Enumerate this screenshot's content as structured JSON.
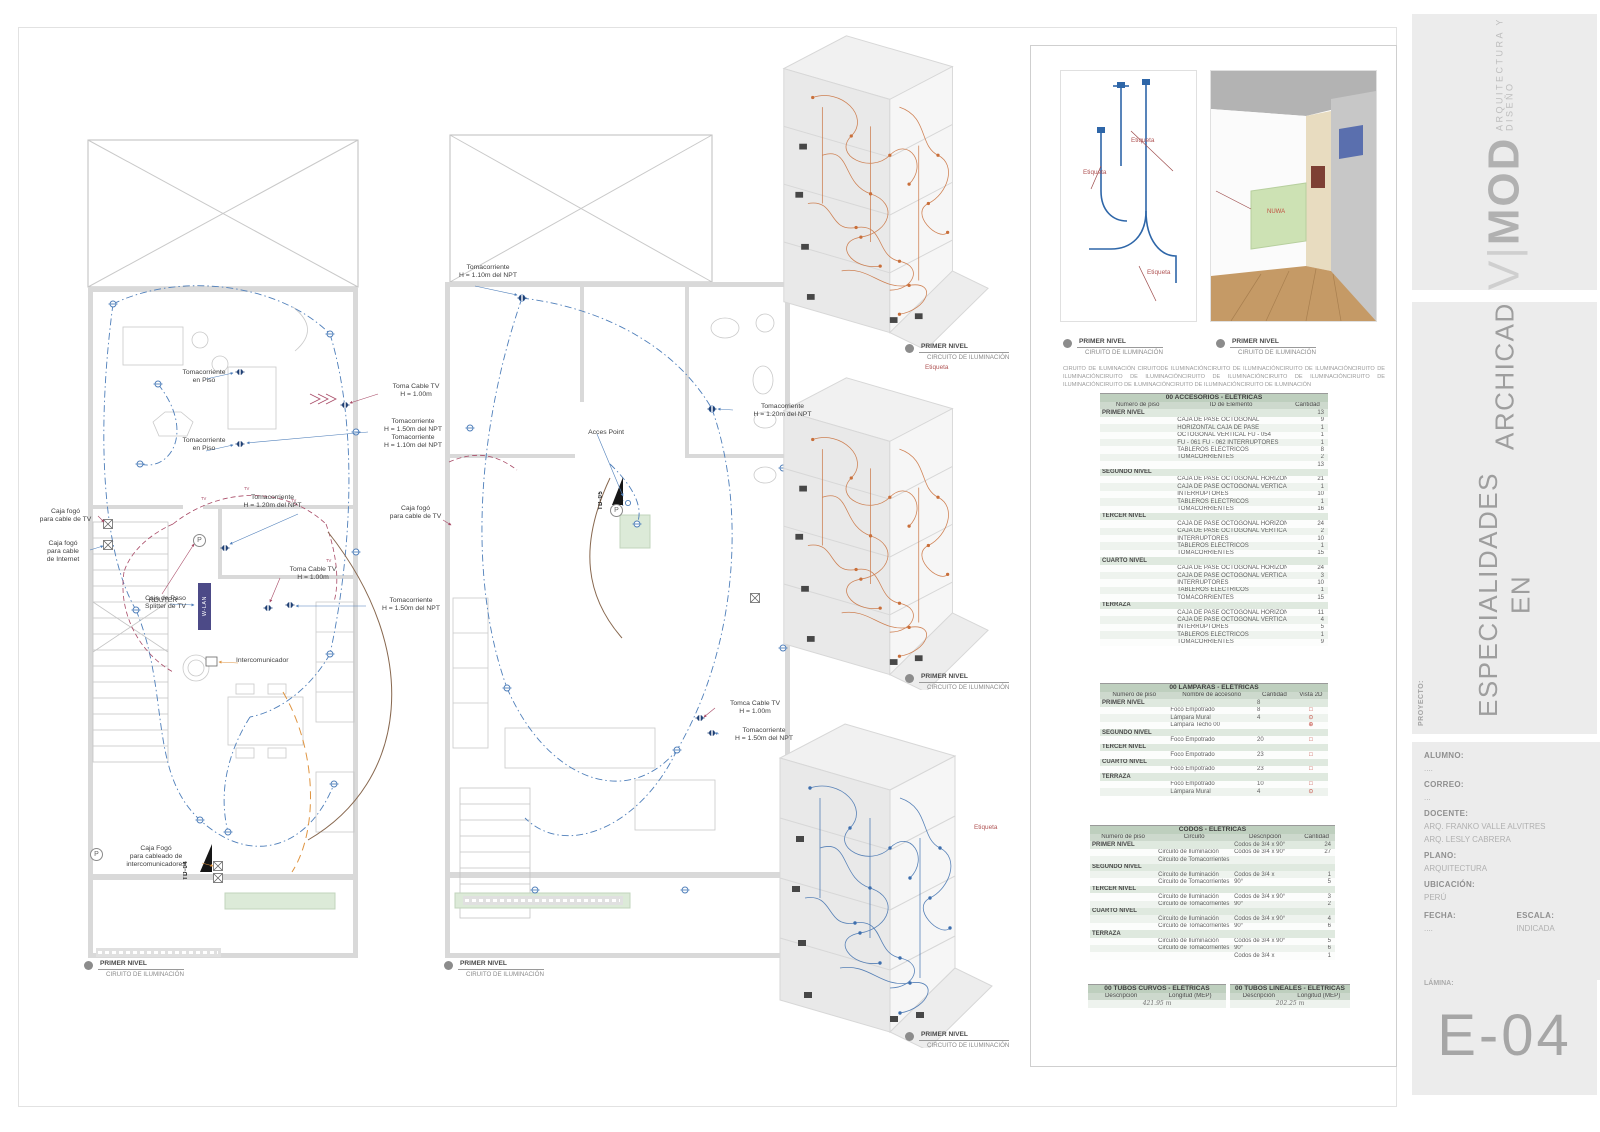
{
  "titleblock": {
    "brand_v": "V|",
    "brand_mod": "MOD",
    "brand_tagline": "ARQUITECTURA Y DISEÑO",
    "title_line1": "ESPECIALIDADES EN",
    "title_line2": "ARCHICAD",
    "proyecto_label": "PROYECTO:",
    "alumno_label": "ALUMNO:",
    "alumno_value": "....",
    "correo_label": "CORREO:",
    "correo_value": "...",
    "docente_label": "DOCENTE:",
    "docente_value_1": "ARQ. FRANKO VALLE ALVITRES",
    "docente_value_2": "ARQ. LESLY CABRERA",
    "plano_label": "PLANO:",
    "plano_value": "ARQUITECTURA",
    "ubicacion_label": "UBICACIÓN:",
    "ubicacion_value": "PERÚ",
    "fecha_label": "FECHA:",
    "fecha_value": "....",
    "escala_label": "ESCALA:",
    "escala_value": "INDICADA",
    "lamina_label": "LÁMINA:",
    "lamina_value": "E-04"
  },
  "plan_left": {
    "caption_title": "PRIMER NIVEL",
    "caption_sub": "CIRUITO DE ILUMINACIÓN",
    "symbols": {
      "p": "P",
      "tv": "TV"
    },
    "annotations": {
      "tomacorriente_piso_1": "Tomacorriente\nen Piso",
      "tomacorriente_piso_2": "Tomacorriente\nen Piso",
      "toma_cable_tv_1": "Toma Cable TV\nH = 1.00m",
      "tomacorriente_150_110": "Tomacorriente\nH = 1.50m del NPT\nTomacorriente\nH = 1.10m del NPT",
      "tomacorriente_120": "Tomacorriente\nH = 1.20m del NPT",
      "caja_fogo_tv": "Caja fogó\npara cable de TV",
      "caja_fogo_internet": "Caja fogó\npara cable\nde Internet",
      "caja_paso_splitter": "Caja de Paso\nSplitter de TV",
      "router": "ROUTER",
      "wlan": "W-LAN",
      "toma_cable_tv_2": "Toma Cable TV\nH = 1.00m",
      "tomacorriente_150": "Tomacorriente\nH = 1.50m del NPT",
      "intercomunicador": "Intercomunicador",
      "caja_fogo_intercom": "Caja Fogó\npara cableado de\nintercomunicadores",
      "td04": "TD-04"
    }
  },
  "plan_mid": {
    "caption_title": "PRIMER NIVEL",
    "caption_sub": "CIRUITO DE ILUMINACIÓN",
    "symbols": {
      "p": "P"
    },
    "annotations": {
      "tomacorriente_110": "Tomacorriente\nH = 1.10m del NPT",
      "acces_point": "Acces Point",
      "tomacorriente_120": "Tomacorriente\nH = 1.20m del NPT",
      "caja_fogo_tv": "Caja fogó\npara cable de TV",
      "tomca_cable_tv": "Tomca Cable TV\nH = 1.00m",
      "tomacorriente_150": "Tomacorriente\nH = 1.50m del NPT",
      "td05": "TD-05"
    }
  },
  "views": {
    "v1_caption_title": "PRIMER NIVEL",
    "v1_caption_sub": "CIRCUITO DE ILUMINACIÓN",
    "v1_etiqueta": "Etiqueta",
    "v2_caption_title": "PRIMER NIVEL",
    "v2_caption_sub": "CIRCUITO DE ILUMINACIÓN",
    "v3_caption_title": "PRIMER NIVEL",
    "v3_caption_sub": "CIRCUITO DE ILUMINACIÓN",
    "v3_etiqueta": "Etiqueta"
  },
  "detail": {
    "legend1_title": "PRIMER NIVEL",
    "legend1_sub": "CIRUITO DE ILUMINACIÓN",
    "legend2_title": "PRIMER NIVEL",
    "legend2_sub": "CIRUITO DE ILUMINACIÓN",
    "paragraph": "CIRUITO DE ILUMINACIÓN CIRUITODE ILUMINACIÓNCIRUITO DE ILUMINACIÓNCIRUITO DE ILUMINACIÓNCIRUITO DE ILUMINACIÓNCIRUITO DE ILUMINACIÓNCIRUITO DE ILUMINACIÓNCIRUITO DE ILUMINACIÓNCIRUITO DE ILUMINACIÓNCIRUITO DE ILUMINACIÓNCIRUITO DE ILUMINACIÓNCIRUITO DE ILUMINACIÓN",
    "etiqueta_1": "Etiqueta",
    "etiqueta_2": "Etiqueta",
    "etiqueta_3": "Etiqueta",
    "render_text": "NUWA"
  },
  "tables": [
    {
      "id": "accesorios",
      "title": "00 ACCESORIOS - ELÉTRICAS",
      "columns": [
        "Número de piso",
        "ID de Elemento",
        "Cantidad"
      ],
      "widths": [
        33,
        49,
        18
      ],
      "rows": [
        [
          "PRIMER NIVEL",
          "",
          "13"
        ],
        [
          "",
          "CAJA DE PASE OCTOGONAL",
          "9"
        ],
        [
          "",
          "HORIZONTAL CAJA DE PASE",
          "1"
        ],
        [
          "",
          "OCTOGONAL VERTICAL FU - 054",
          "1"
        ],
        [
          "",
          "FU - 061 FU - 062 INTERRUPTORES",
          "1"
        ],
        [
          "",
          "TABLEROS ELÉCTRICOS",
          "8"
        ],
        [
          "",
          "TOMACORRIENTES",
          "2"
        ],
        [
          "",
          "",
          "13"
        ],
        [
          "SEGUNDO NIVEL",
          "",
          ""
        ],
        [
          "",
          "CAJA DE PASE OCTOGONAL HORIZONTAL",
          "21"
        ],
        [
          "",
          "CAJA DE PASE OCTOGONAL VERTICAL",
          "1"
        ],
        [
          "",
          "INTERRUPTORES",
          "10"
        ],
        [
          "",
          "TABLEROS ELÉCTRICOS",
          "1"
        ],
        [
          "",
          "TOMACORRIENTES",
          "16"
        ],
        [
          "TERCER NIVEL",
          "",
          ""
        ],
        [
          "",
          "CAJA DE PASE OCTOGONAL HORIZONTAL",
          "24"
        ],
        [
          "",
          "CAJA DE PASE OCTOGONAL VERTICAL",
          "2"
        ],
        [
          "",
          "INTERRUPTORES",
          "10"
        ],
        [
          "",
          "TABLEROS ELÉCTRICOS",
          "1"
        ],
        [
          "",
          "TOMACORRIENTES",
          "15"
        ],
        [
          "CUARTO NIVEL",
          "",
          ""
        ],
        [
          "",
          "CAJA DE PASE OCTOGONAL HORIZONTAL",
          "24"
        ],
        [
          "",
          "CAJA DE PASE OCTOGONAL VERTICAL",
          "3"
        ],
        [
          "",
          "INTERRUPTORES",
          "10"
        ],
        [
          "",
          "TABLEROS ELÉCTRICOS",
          "1"
        ],
        [
          "",
          "TOMACORRIENTES",
          "15"
        ],
        [
          "TERRAZA",
          "",
          ""
        ],
        [
          "",
          "CAJA DE PASE OCTOGONAL HORIZONTAL",
          "11"
        ],
        [
          "",
          "CAJA DE PASE OCTOGONAL VERTICAL",
          "4"
        ],
        [
          "",
          "INTERRUPTORES",
          "5"
        ],
        [
          "",
          "TABLEROS ELÉCTRICOS",
          "1"
        ],
        [
          "",
          "TOMACORRIENTES",
          "9"
        ]
      ]
    },
    {
      "id": "lamparas",
      "title": "00 LÁMPARAS - ELÉTRICAS",
      "columns": [
        "Número de piso",
        "Nombre de accesorio",
        "Cantidad",
        "Vista 2D"
      ],
      "widths": [
        30,
        38,
        17,
        15
      ],
      "rows": [
        [
          "PRIMER NIVEL",
          "",
          "8",
          ""
        ],
        [
          "",
          "Foco Empotrado",
          "8",
          "icon:foco"
        ],
        [
          "",
          "Lámpara Mural",
          "4",
          "icon:mural"
        ],
        [
          "",
          "Lámpara Techo 00",
          "",
          "icon:techo"
        ],
        [
          "SEGUNDO NIVEL",
          "",
          "",
          ""
        ],
        [
          "",
          "Foco Empotrado",
          "20",
          "icon:foco"
        ],
        [
          "TERCER NIVEL",
          "",
          "",
          ""
        ],
        [
          "",
          "Foco Empotrado",
          "23",
          "icon:foco"
        ],
        [
          "CUARTO NIVEL",
          "",
          "",
          ""
        ],
        [
          "",
          "Foco Empotrado",
          "23",
          "icon:foco"
        ],
        [
          "TERRAZA",
          "",
          "",
          ""
        ],
        [
          "",
          "Foco Empotrado",
          "10",
          "icon:foco"
        ],
        [
          "",
          "Lámpara Mural",
          "4",
          "icon:mural"
        ]
      ]
    },
    {
      "id": "codos",
      "title": "CODOS - ELÉTRICAS",
      "columns": [
        "Número de piso",
        "Circuito",
        "Descripción",
        "Cantidad"
      ],
      "widths": [
        27,
        31,
        27,
        15
      ],
      "rows": [
        [
          "PRIMER NIVEL",
          "",
          "Codos de 3/4 x 90°",
          "24"
        ],
        [
          "",
          "Circuito de Iluminación",
          "Codos de 3/4 x 90°",
          "27"
        ],
        [
          "",
          "Circuito de Tomacorrientes",
          "",
          ""
        ],
        [
          "SEGUNDO NIVEL",
          "",
          "",
          ""
        ],
        [
          "",
          "Circuito de Iluminación",
          "Codos de 3/4 x",
          "1"
        ],
        [
          "",
          "Circuito de Tomacorrientes",
          "90°",
          "5"
        ],
        [
          "TERCER NIVEL",
          "",
          "",
          ""
        ],
        [
          "",
          "Circuito de Iluminación",
          "Codos de 3/4 x 90°",
          "3"
        ],
        [
          "",
          "Circuito de Tomacorrientes",
          "90°",
          "2"
        ],
        [
          "CUARTO NIVEL",
          "",
          "",
          ""
        ],
        [
          "",
          "Circuito de Iluminación",
          "Codos de 3/4 x 90°",
          "4"
        ],
        [
          "",
          "Circuito de Tomacorrientes",
          "90°",
          "6"
        ],
        [
          "TERRAZA",
          "",
          "",
          ""
        ],
        [
          "",
          "Circuito de Iluminación",
          "Codos de 3/4 x 90°",
          "5"
        ],
        [
          "",
          "Circuito de Tomacorrientes",
          "90°",
          "6"
        ],
        [
          "",
          "",
          "Codos de 3/4 x",
          "1"
        ]
      ]
    },
    {
      "id": "tubos_curvos",
      "title": "00 TUBOS CURVOS - ELÉTRICAS",
      "columns": [
        "Descripción",
        "Longitud (MEP)"
      ],
      "widths": [
        48,
        52
      ],
      "script": true,
      "rows": [
        [
          "",
          "421.95 m"
        ]
      ]
    },
    {
      "id": "tubos_lineales",
      "title": "00 TUBOS LINEALES - ELÉTRICAS",
      "columns": [
        "Descripción",
        "Longitud (MEP)"
      ],
      "widths": [
        48,
        52
      ],
      "script": true,
      "rows": [
        [
          "",
          "202.25 m"
        ]
      ]
    }
  ]
}
